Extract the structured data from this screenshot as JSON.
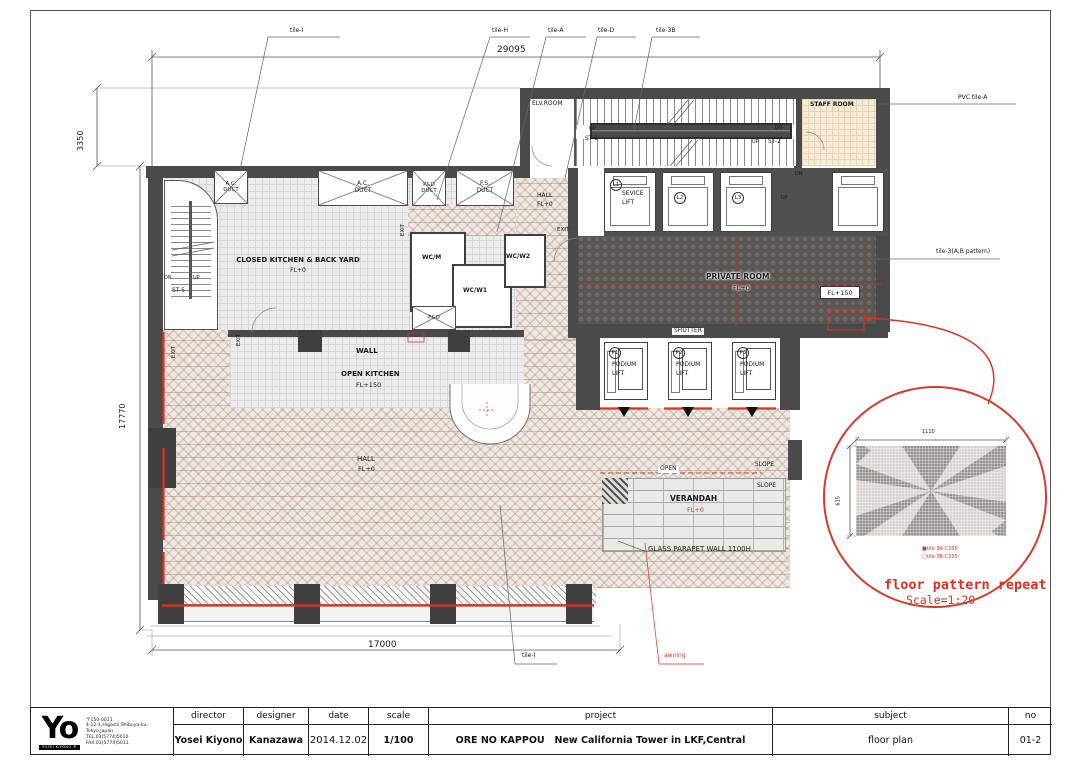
{
  "colors": {
    "accent_red": "#e0301e",
    "wall_gray": "#4a4a4a"
  },
  "plan": {
    "dim_top": "29095",
    "dim_left_upper": "3350",
    "dim_left": "17770",
    "dim_bottom": "17000",
    "tags": {
      "tile_i": "tile-I",
      "tile_h": "tile-H",
      "tile_a": "tile-A",
      "tile_d": "tile-D",
      "tile_3b": "tile-3B",
      "pvc": "PVC tile-A",
      "tile_3ab": "tile-3(A,B pattern)",
      "tile_i_bottom": "tile-I",
      "awning": "awning"
    },
    "rooms": {
      "elv": "ELV.ROOM",
      "staff": "STAFF ROOM",
      "st1": "ST-1",
      "st2": "ST-2",
      "st5": "ST-5",
      "closed_kitchen": "CLOSED KITCHEN & BACK YARD",
      "open_kitchen": "OPEN KITCHEN",
      "hall": "HALL",
      "private": "PRIVATE ROOM",
      "verandah": "VERANDAH",
      "wcm": "WC/M",
      "wcw1": "WC/W1",
      "wcw2": "WC/W2",
      "fo": "F&O",
      "l1": "L1",
      "l2": "L2",
      "l3": "L3",
      "sevice": "SEVICE",
      "lift": "LIFT",
      "p1": "P1",
      "p2": "P2",
      "p3": "P3",
      "podium": "PODIUM"
    },
    "marks": {
      "up": "UP",
      "dn": "DN",
      "exit": "EXIT",
      "wall": "WALL",
      "shutter": "SHUTTER",
      "open": "OPEN",
      "slope": "SLOPE",
      "fl0": "FL+0",
      "fl150": "FL+150",
      "ac": "A.C.",
      "pd": "P&D",
      "fs": "F.S.",
      "duct": "DUCT",
      "parapet": "GLASS PARAPET WALL 1100H"
    }
  },
  "detail": {
    "dim_w": "1110",
    "dim_h": "615",
    "legend1": "■tile-3A C335",
    "legend2": "□tile-3B C335",
    "caption": "floor pattern repeat",
    "caption_scale": "Scale=1:20"
  },
  "title_block": {
    "logo": {
      "text": "Yo",
      "caption": "YOSEI KIYONO ®"
    },
    "address": [
      "〒150-0011",
      "4-12-1,Higashi,Shibuya-ku,",
      "Tokyo,Japan",
      "TEL.03(5774)5010",
      "FAX.03(5774)5011"
    ],
    "director_label": "director",
    "director": "Yosei Kiyono",
    "designer_label": "designer",
    "designer": "Kanazawa",
    "date_label": "date",
    "date": "2014.12.02",
    "scale_label": "scale",
    "scale": "1/100",
    "project_label": "project",
    "project": "ORE NO KAPPOU   New California Tower in LKF,Central",
    "subject_label": "subject",
    "subject": "floor plan",
    "no_label": "no",
    "no": "01-2"
  }
}
